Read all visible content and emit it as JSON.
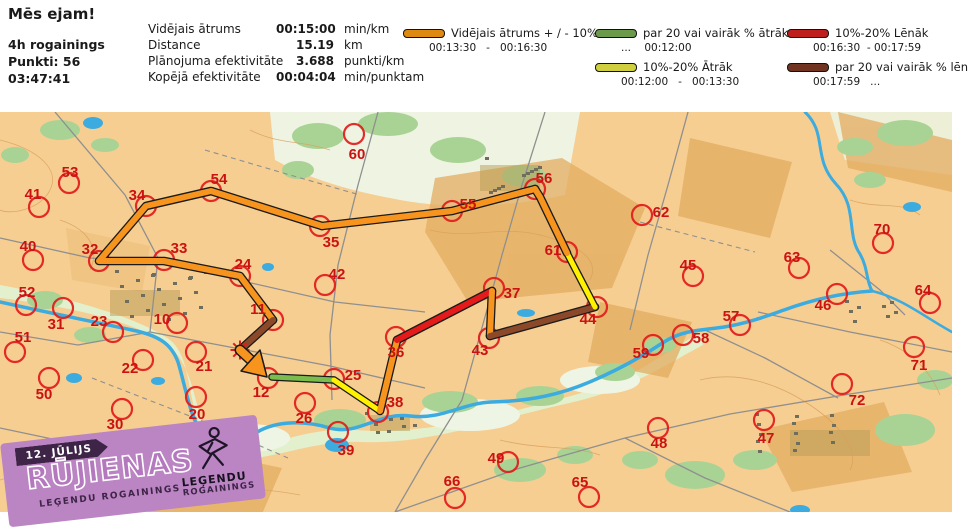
{
  "header": {
    "title": "Mēs ejam!",
    "event": "4h rogainings",
    "points": "Punkti: 56",
    "time": "03:47:41",
    "stats": [
      {
        "label": "Vidējais ātrums",
        "value": "00:15:00",
        "unit": "min/km"
      },
      {
        "label": "Distance",
        "value": "15.19",
        "unit": "km"
      },
      {
        "label": "Plānojuma efektivitāte",
        "value": "3.688",
        "unit": "punkti/km"
      },
      {
        "label": "Kopējā efektivitāte",
        "value": "00:04:04",
        "unit": "min/punktam"
      }
    ]
  },
  "legend": {
    "items": [
      {
        "label": "Vidējais ātrums + / - 10%",
        "range": "00:13:30   -   00:16:30",
        "color": "#DE8A10"
      },
      {
        "label": "par 20 vai vairāk % ātrāk",
        "range": "...    00:12:00",
        "color": "#6C9A4B"
      },
      {
        "label": "10%-20% Ātrāk",
        "range": "00:12:00   -   00:13:30",
        "color": "#CFCF40"
      },
      {
        "label": "10%-20% Lēnāk",
        "range": "00:16:30  - 00:17:59",
        "color": "#BE1E1E"
      },
      {
        "label": "par 20 vai vairāk % lēnāk",
        "range": "00:17:59   ...",
        "color": "#703420"
      }
    ]
  },
  "badge": {
    "date": "12. JŪLIJS",
    "title": "RŪJIENAS",
    "subtitle": "LEĢENDU ROGAININGS",
    "logo_top": "LEĢENDU",
    "logo_bottom": "ROGAININGS"
  },
  "map": {
    "colors": {
      "control": "#E21B1B",
      "label": "#CB1212"
    },
    "controls": [
      [
        "53",
        69,
        183,
        70,
        177
      ],
      [
        "41",
        39,
        207,
        33,
        199
      ],
      [
        "34",
        146,
        206,
        137,
        200
      ],
      [
        "54",
        211,
        191,
        219,
        184
      ],
      [
        "60",
        354,
        134,
        357,
        159
      ],
      [
        "35",
        320,
        226,
        331,
        247
      ],
      [
        "55",
        452,
        211,
        468,
        209
      ],
      [
        "56",
        535,
        189,
        544,
        183
      ],
      [
        "61",
        567,
        252,
        553,
        255
      ],
      [
        "62",
        642,
        215,
        661,
        217
      ],
      [
        "70",
        883,
        243,
        882,
        234
      ],
      [
        "63",
        799,
        268,
        792,
        262
      ],
      [
        "45",
        693,
        276,
        688,
        270
      ],
      [
        "64",
        930,
        303,
        923,
        295
      ],
      [
        "40",
        33,
        260,
        28,
        251
      ],
      [
        "32",
        99,
        261,
        90,
        254
      ],
      [
        "33",
        164,
        260,
        179,
        253
      ],
      [
        "24",
        240,
        276,
        243,
        269
      ],
      [
        "42",
        325,
        285,
        337,
        279
      ],
      [
        "37",
        494,
        288,
        512,
        298
      ],
      [
        "52",
        26,
        305,
        27,
        297
      ],
      [
        "31",
        63,
        308,
        56,
        329
      ],
      [
        "23",
        113,
        332,
        99,
        326
      ],
      [
        "10",
        177,
        323,
        162,
        324
      ],
      [
        "46",
        837,
        294,
        823,
        310
      ],
      [
        "43",
        489,
        338,
        480,
        355
      ],
      [
        "44",
        597,
        307,
        588,
        324
      ],
      [
        "36",
        396,
        337,
        396,
        357
      ],
      [
        "11",
        273,
        320,
        258,
        314
      ],
      [
        "51",
        15,
        352,
        23,
        342
      ],
      [
        "22",
        143,
        360,
        130,
        373
      ],
      [
        "21",
        196,
        352,
        204,
        371
      ],
      [
        "25",
        334,
        379,
        353,
        380
      ],
      [
        "12",
        268,
        378,
        261,
        397
      ],
      [
        "26",
        305,
        403,
        304,
        423
      ],
      [
        "38",
        378,
        412,
        395,
        407
      ],
      [
        "59",
        653,
        345,
        641,
        358
      ],
      [
        "58",
        683,
        335,
        701,
        343
      ],
      [
        "57",
        740,
        325,
        731,
        321
      ],
      [
        "71",
        914,
        347,
        919,
        370
      ],
      [
        "72",
        842,
        384,
        857,
        405
      ],
      [
        "30",
        122,
        409,
        115,
        429
      ],
      [
        "20",
        196,
        397,
        197,
        419
      ],
      [
        "50",
        49,
        378,
        44,
        399
      ],
      [
        "39",
        338,
        432,
        346,
        455
      ],
      [
        "49",
        508,
        462,
        496,
        463
      ],
      [
        "66",
        455,
        498,
        452,
        486
      ],
      [
        "65",
        589,
        497,
        580,
        487
      ],
      [
        "48",
        658,
        428,
        659,
        448
      ],
      [
        "47",
        764,
        420,
        766,
        443
      ]
    ],
    "route_legs": [
      {
        "color": "#7ABD4C",
        "w": 5,
        "p": [
          [
            272,
            377
          ],
          [
            334,
            380
          ]
        ]
      },
      {
        "color": "#FFF100",
        "w": 5,
        "p": [
          [
            334,
            380
          ],
          [
            380,
            411
          ]
        ]
      },
      {
        "color": "#F7941E",
        "w": 6,
        "p": [
          [
            380,
            411
          ],
          [
            397,
            340
          ]
        ]
      },
      {
        "color": "#E51A1B",
        "w": 6,
        "p": [
          [
            397,
            340
          ],
          [
            492,
            291
          ]
        ]
      },
      {
        "color": "#F7941E",
        "w": 6,
        "p": [
          [
            492,
            291
          ],
          [
            490,
            336
          ]
        ]
      },
      {
        "color": "#8C4929",
        "w": 6,
        "p": [
          [
            490,
            336
          ],
          [
            595,
            307
          ]
        ]
      },
      {
        "color": "#FFF100",
        "w": 5,
        "p": [
          [
            595,
            307
          ],
          [
            567,
            253
          ]
        ]
      },
      {
        "color": "#F7941E",
        "w": 6,
        "p": [
          [
            567,
            253
          ],
          [
            540,
            197
          ],
          [
            535,
            189
          ]
        ]
      },
      {
        "color": "#F7941E",
        "w": 6,
        "p": [
          [
            535,
            189
          ],
          [
            452,
            211
          ],
          [
            322,
            226
          ]
        ]
      },
      {
        "color": "#F7941E",
        "w": 6,
        "p": [
          [
            322,
            226
          ],
          [
            211,
            191
          ],
          [
            146,
            206
          ],
          [
            99,
            261
          ],
          [
            164,
            261
          ],
          [
            240,
            276
          ],
          [
            273,
            320
          ]
        ]
      },
      {
        "color": "#8C4929",
        "w": 6,
        "p": [
          [
            273,
            320
          ],
          [
            240,
            350
          ]
        ]
      }
    ],
    "start": {
      "x": 240,
      "y": 350
    },
    "finish_arrow": {
      "color": "#F7941E",
      "shaft": [
        [
          240,
          350
        ],
        [
          253,
          362
        ]
      ],
      "head": [
        [
          267,
          377
        ],
        [
          241,
          371
        ],
        [
          260,
          350
        ]
      ]
    }
  }
}
